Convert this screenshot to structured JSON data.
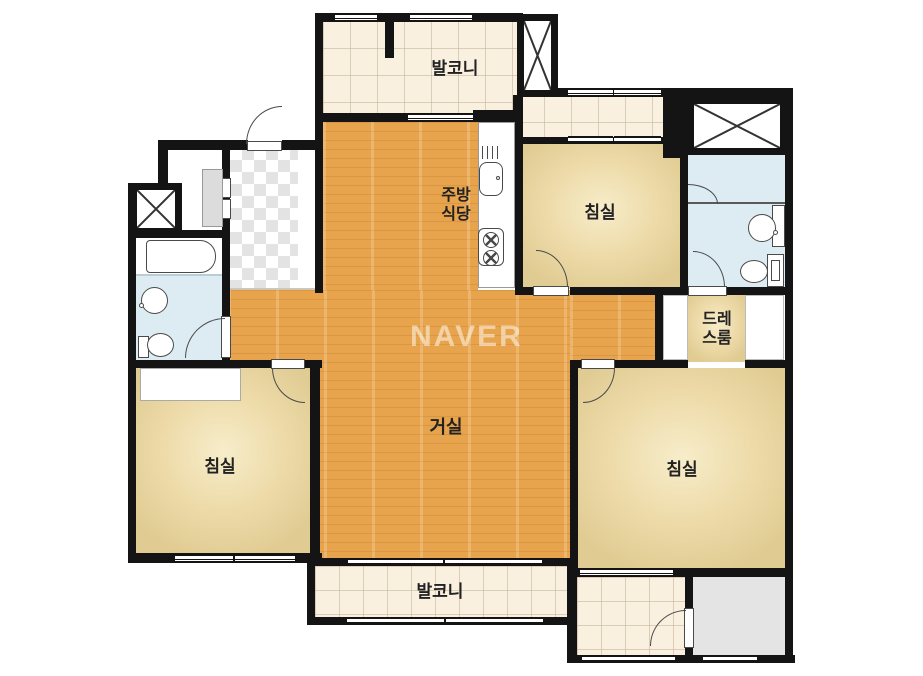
{
  "brand": {
    "watermark": "NAVER"
  },
  "rooms": {
    "balcony_top": {
      "label": "발코니"
    },
    "kitchen": {
      "line1": "주방",
      "line2": "식당"
    },
    "bedroom_top": {
      "label": "침실"
    },
    "dressing": {
      "line1": "드레",
      "line2": "스룸"
    },
    "living": {
      "label": "거실"
    },
    "bedroom_left": {
      "label": "침실"
    },
    "bedroom_right": {
      "label": "침실"
    },
    "balcony_bottom": {
      "label": "발코니"
    }
  },
  "colors": {
    "wall": "#141414",
    "wood_floor": "#e7a44d",
    "bedroom_floor": "#eddaa8",
    "balcony_tile": "#faf0df",
    "bathroom_floor": "#dcecf2",
    "utility_floor": "#e4e4e4",
    "watermark": "rgba(255,255,255,0.5)"
  },
  "fixtures": [
    "bathtub",
    "wash-basin",
    "toilet",
    "kitchen-sink",
    "cooktop",
    "vent-hood",
    "shower-screen",
    "elevator-shaft",
    "duct-shaft",
    "wardrobe",
    "shoe-closet"
  ]
}
